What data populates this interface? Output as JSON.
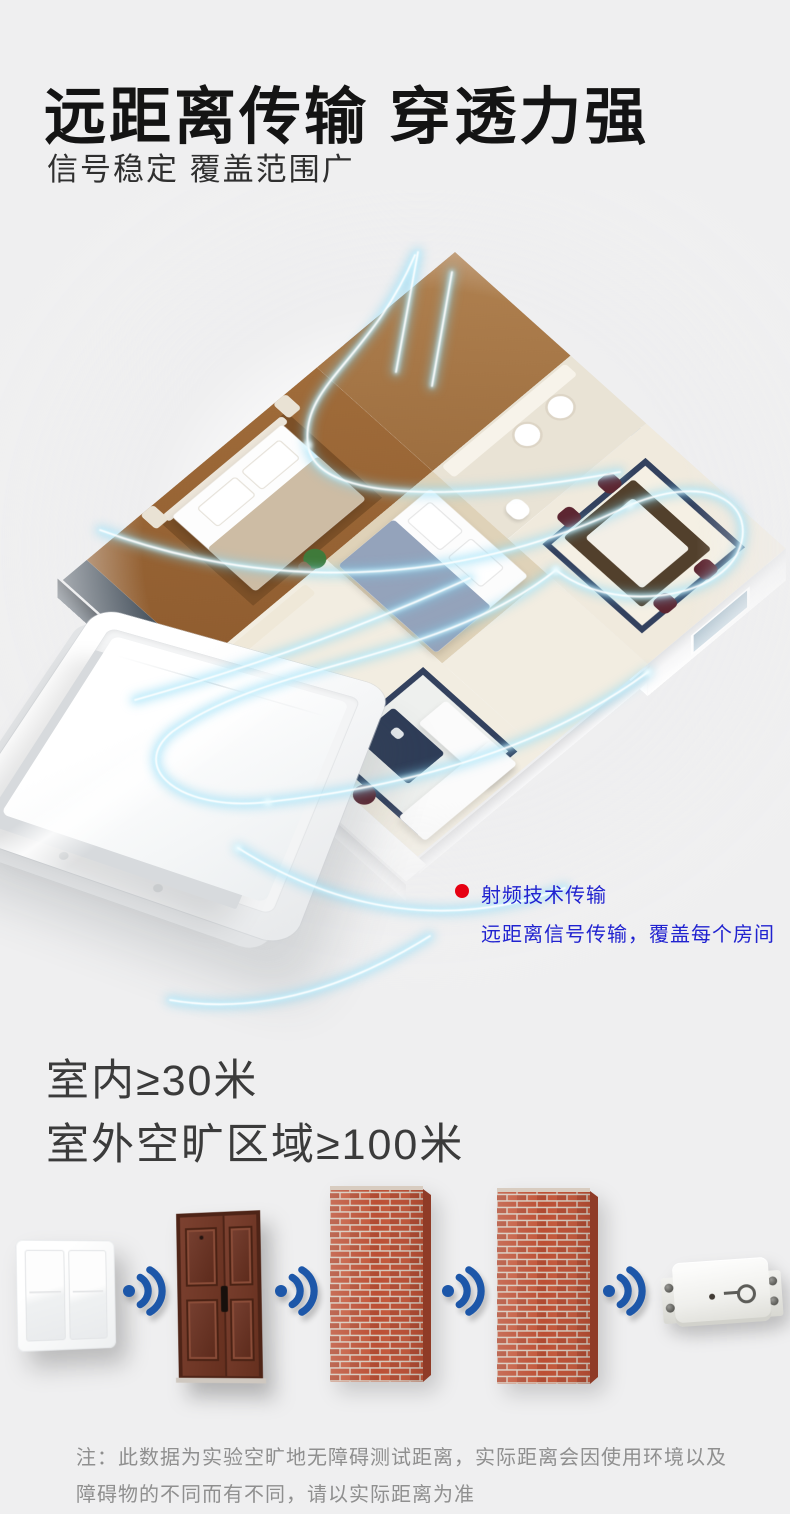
{
  "page": {
    "background": "#efeff0"
  },
  "header": {
    "title": "远距离传输 穿透力强",
    "subtitle": "信号稳定 覆盖范围广"
  },
  "hero": {
    "annotation": {
      "title": "射频技术传输",
      "description": "远距离信号传输，覆盖每个房间",
      "text_color": "#2022d0",
      "bullet_color": "#e60012"
    },
    "glow_color": "#9fe3fb"
  },
  "claims": {
    "indoor": "室内≥30米",
    "outdoor": "室外空旷区域≥100米"
  },
  "transmission": {
    "signal_color": "#1d57a9",
    "brick_color": "#bc4f34",
    "items": [
      {
        "icon": "wall-switch-icon"
      },
      {
        "icon": "wifi-signal-icon"
      },
      {
        "icon": "security-door-icon"
      },
      {
        "icon": "wifi-signal-icon"
      },
      {
        "icon": "brick-wall-icon"
      },
      {
        "icon": "wifi-signal-icon"
      },
      {
        "icon": "brick-wall-icon"
      },
      {
        "icon": "wifi-signal-icon"
      },
      {
        "icon": "receiver-module-icon"
      }
    ]
  },
  "footnote": {
    "line1": "注：此数据为实验空旷地无障碍测试距离，实际距离会因使用环境以及",
    "line2": "障碍物的不同而有不同，请以实际距离为准"
  }
}
